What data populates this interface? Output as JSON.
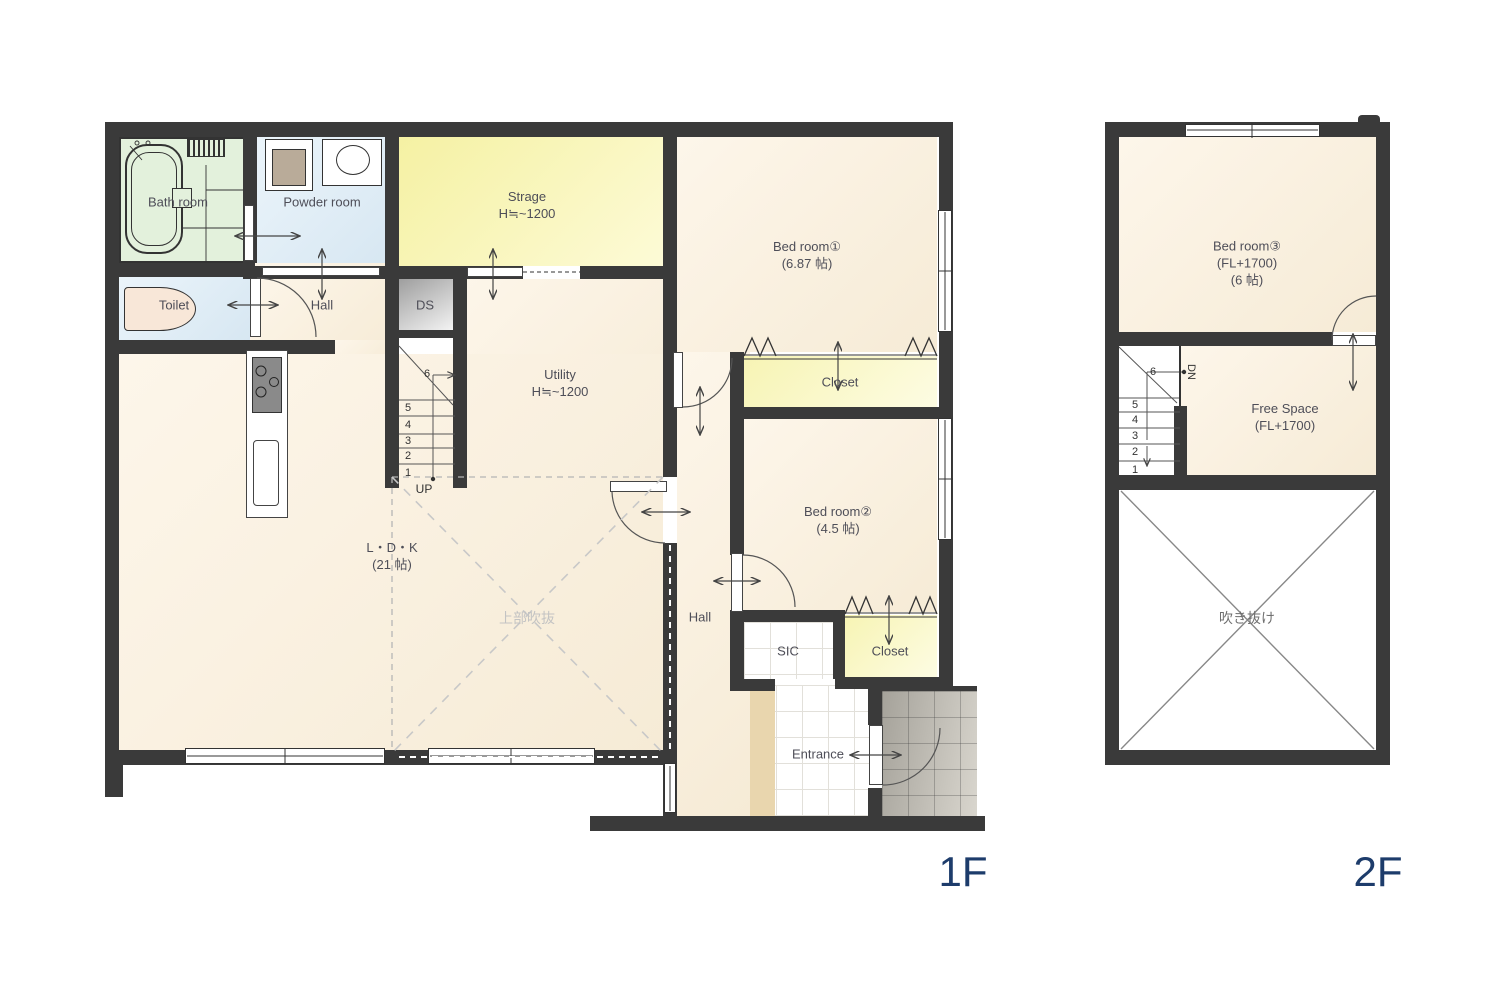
{
  "floor1": {
    "label": "1F",
    "rooms": {
      "bath": "Bath room",
      "powder": "Powder room",
      "toilet": "Toilet",
      "hall_left": "Hall",
      "strage_name": "Strage",
      "strage_h": "H≒~1200",
      "ds": "DS",
      "utility_name": "Utility",
      "utility_h": "H≒~1200",
      "bed1_name": "Bed room①",
      "bed1_size": "(6.87 帖)",
      "closet1": "Closet",
      "bed2_name": "Bed room②",
      "bed2_size": "(4.5 帖)",
      "hall_right": "Hall",
      "sic": "SIC",
      "closet2": "Closet",
      "entrance": "Entrance",
      "ldk_name": "L・D・K",
      "ldk_size": "(21 帖)",
      "void_note": "上部吹抜",
      "up": "UP"
    },
    "stairs": {
      "s1": "1",
      "s2": "2",
      "s3": "3",
      "s4": "4",
      "s5": "5",
      "s6": "6"
    }
  },
  "floor2": {
    "label": "2F",
    "rooms": {
      "bed3_name": "Bed room③",
      "bed3_fl": "(FL+1700)",
      "bed3_size": "(6 帖)",
      "free_name": "Free Space",
      "free_fl": "(FL+1700)",
      "void": "吹き抜け",
      "dn": "DN"
    },
    "stairs": {
      "s1": "1",
      "s2": "2",
      "s3": "3",
      "s4": "4",
      "s5": "5",
      "s6": "6"
    }
  },
  "colors": {
    "wall": "#3a3a3a",
    "floor_label": "#1d3c6b",
    "strage_fill": "#f5f1a3",
    "bath_fill": "#e3f1dc",
    "water_fill": "#d7e7f2"
  }
}
